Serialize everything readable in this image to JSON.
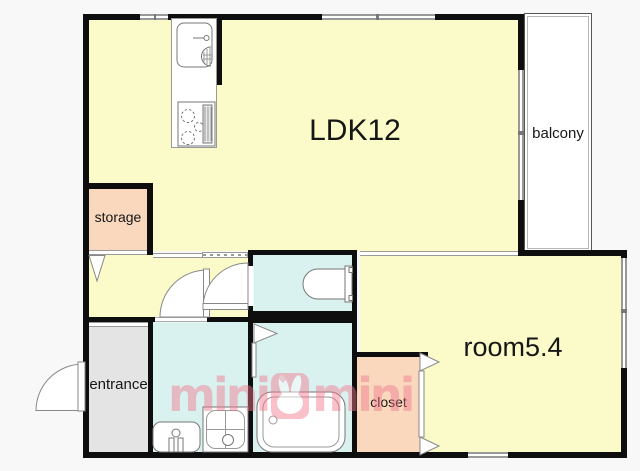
{
  "floorplan": {
    "rooms": {
      "ldk": {
        "label": "LDK12"
      },
      "balcony": {
        "label": "balcony"
      },
      "storage": {
        "label": "storage"
      },
      "entrance": {
        "label": "entrance"
      },
      "room": {
        "label": "room5.4"
      },
      "closet": {
        "label": "closet"
      }
    },
    "watermark": {
      "left_text": "mini",
      "right_text": "mini"
    },
    "fixtures": [
      "kitchen-sink-icon",
      "stove-icon",
      "toilet-icon",
      "bathtub-icon",
      "washbasin-icon",
      "washing-machine-pan-icon",
      "entrance-door-swing-icon",
      "washroom-door-swing-icon",
      "toilet-door-swing-icon",
      "bathroom-door-icon",
      "closet-door-icon",
      "storage-door-icon",
      "window-icon"
    ],
    "colors": {
      "room_yellow": "#fbfbc9",
      "wet_blue": "#d9f2f0",
      "storage_peach": "#f9d8be",
      "entrance_gray": "#e4e4e4",
      "wall_black": "#0e0e0e",
      "window_gray": "#999999",
      "watermark_pink": "#f2768c",
      "background": "#f8f8f8"
    }
  }
}
